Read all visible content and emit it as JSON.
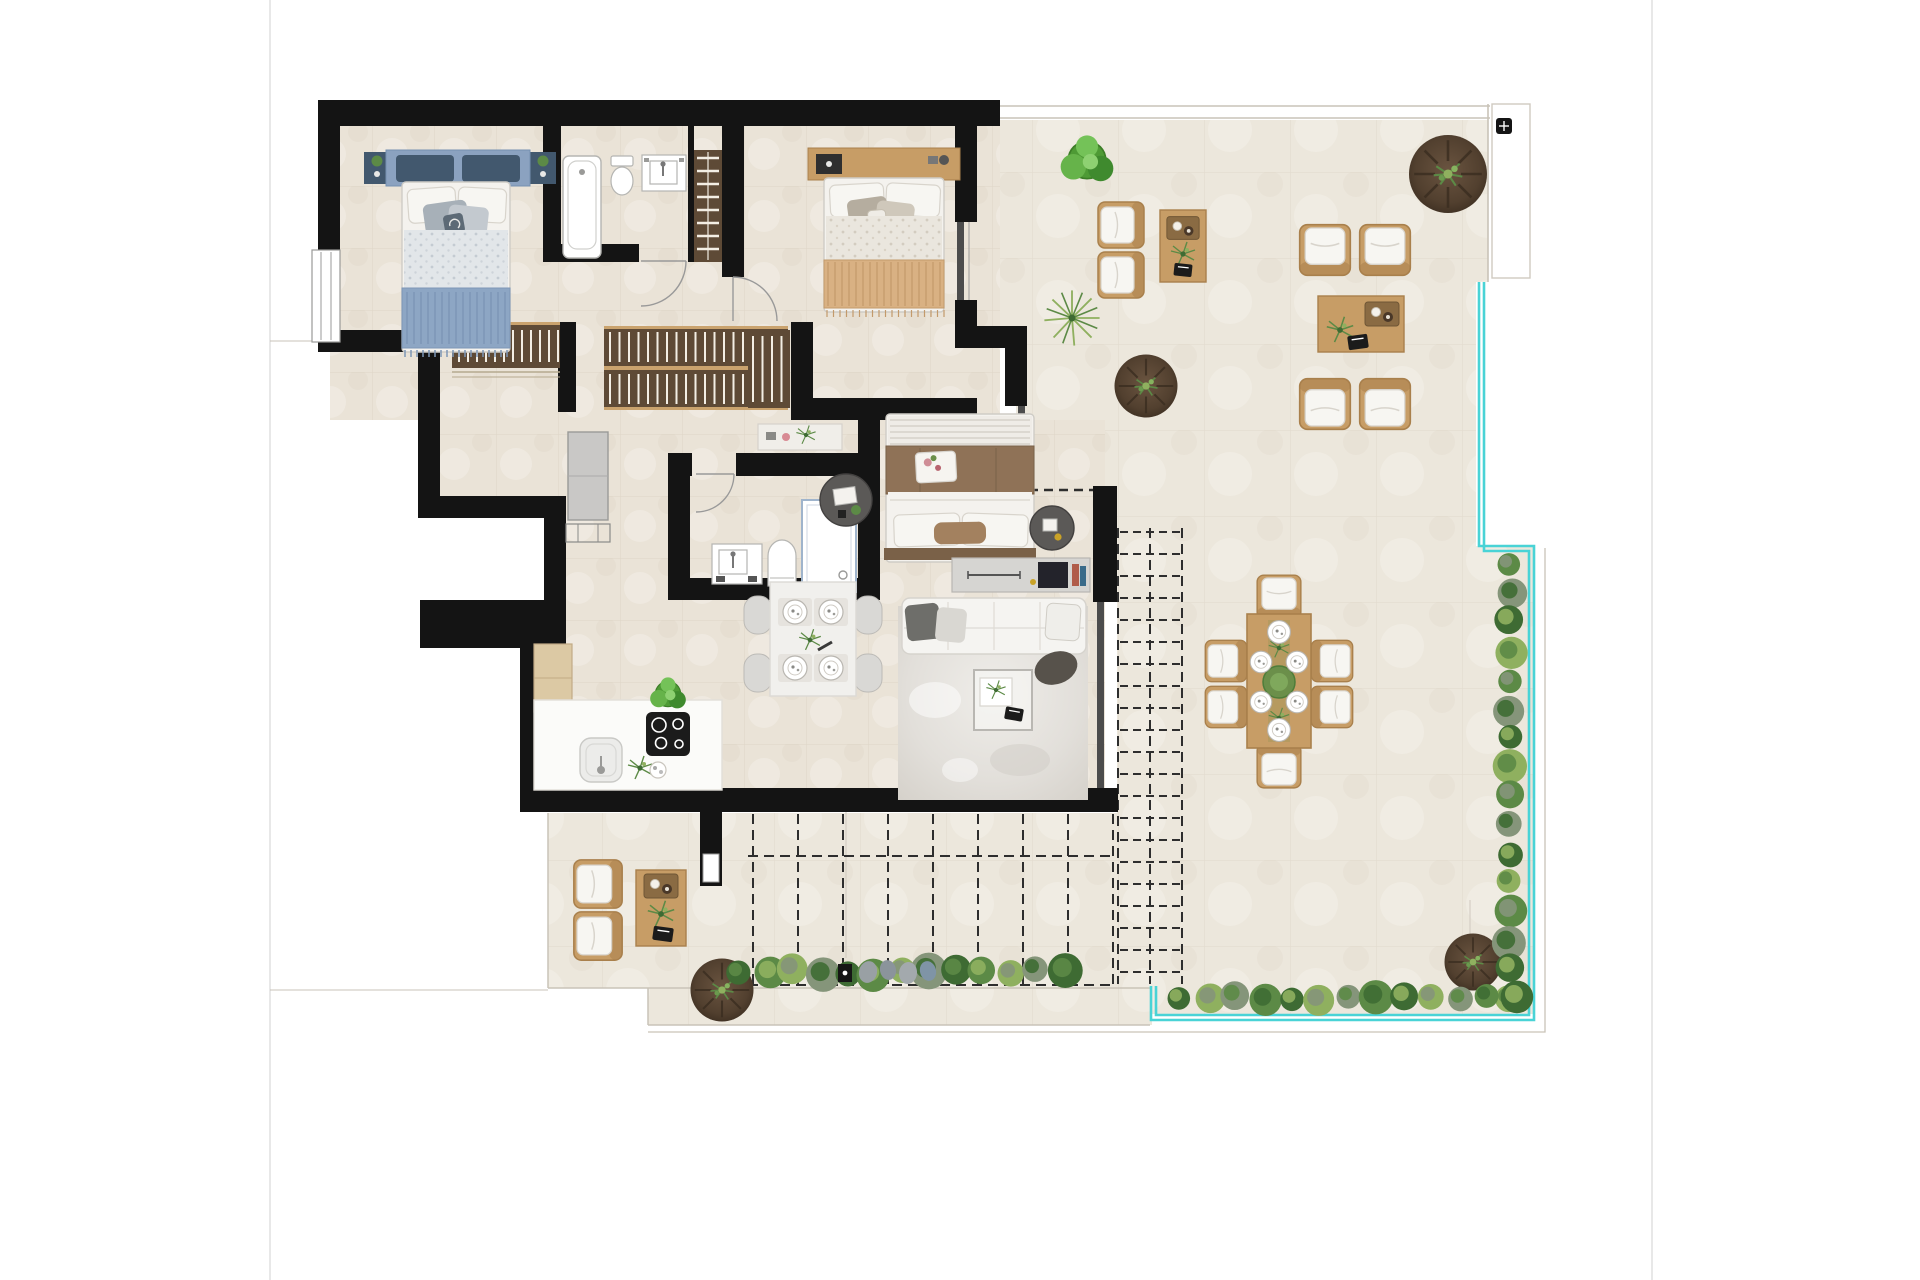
{
  "canvas": {
    "width": 1920,
    "height": 1280
  },
  "palette": {
    "wall": "#141414",
    "floorI": "#eae3d7",
    "floorT": "#ece7dc",
    "tileLine": "#d6cdbd",
    "wood": "#c79d66",
    "woodDark": "#a9804c",
    "closet": "#5e4a36",
    "closetSlat": "#f3eee4",
    "closetTrim": "#caa36e",
    "cushion": "#f7f6f2",
    "cushionBorder": "#d8d4cc",
    "pool": "#49d3d6",
    "lineGray": "#c9c3b8",
    "pageLine": "#e0e0e0",
    "dash": "#2e2e2e",
    "glass": "#4c4c4c",
    "plantDark": "#3e6b33",
    "plantMid": "#5c8a46",
    "plantLight": "#8fb05f",
    "plantSage": "#85957a",
    "planter": "#5a4633",
    "planterDark": "#3a2d20",
    "bedBlue": "#8da6c4",
    "blueDark": "#42586e",
    "blueHead": "#8ba2c0",
    "blueLine": "#7d96b6",
    "duvetBlue": "#e2e6e9",
    "bedTan": "#d9b183",
    "tanLine": "#c39a6b",
    "duvetTan": "#eae6de",
    "bedBrown": "#8f7257",
    "brownDark": "#7a6148",
    "whiteSoft": "#f4f2ee",
    "softBorder": "#cfccc6",
    "rug": "#e4e1dc",
    "console": "#d6d5d2",
    "stripeLight": "#dcd8d1",
    "tableWhite": "#f1f0ed",
    "grayUnit": "#c9c8c6",
    "fixtureBorder": "#b5b5b2"
  },
  "rooms": [
    {
      "id": "bedroom-blue"
    },
    {
      "id": "bathroom-main"
    },
    {
      "id": "bedroom-tan"
    },
    {
      "id": "hallway-closets"
    },
    {
      "id": "bathroom-ensuite"
    },
    {
      "id": "master-bedroom"
    },
    {
      "id": "kitchen-dining"
    },
    {
      "id": "living-room"
    },
    {
      "id": "terrace"
    },
    {
      "id": "terrace-lounge-sw"
    }
  ],
  "generators": [
    {
      "t": "gBedA",
      "k": "plants",
      "x": 740,
      "y": 972,
      "dx": 27,
      "dy": 0,
      "n": 13,
      "r": 15,
      "jit": 7,
      "colors": [
        "plantDark",
        "plantMid",
        "plantLight",
        "plantSage"
      ]
    },
    {
      "t": "gBedB",
      "k": "plants",
      "x": 1510,
      "y": 564,
      "dx": 0,
      "dy": 29,
      "n": 16,
      "r": 14,
      "jit": 5,
      "colors": [
        "plantMid",
        "plantSage",
        "plantDark",
        "plantLight"
      ]
    },
    {
      "t": "gBedC",
      "k": "plants",
      "x": 1180,
      "y": 998,
      "dx": 28,
      "dy": 0,
      "n": 13,
      "r": 14,
      "jit": 5,
      "colors": [
        "plantDark",
        "plantLight",
        "plantSage",
        "plantMid"
      ]
    },
    {
      "t": "gPergER",
      "k": "lines",
      "x1": 1120,
      "y1": 532,
      "x2": 1180,
      "y2": 532,
      "dx": 0,
      "dy": 22,
      "n": 21,
      "stroke": "dash",
      "w": 2,
      "dash": "8 5"
    },
    {
      "t": "gPergEV",
      "k": "lines",
      "x1": 1118,
      "y1": 528,
      "x2": 1118,
      "y2": 984,
      "dx": 32,
      "dy": 0,
      "n": 3,
      "stroke": "dash",
      "w": 2,
      "dash": "10 6"
    },
    {
      "t": "gPergSV",
      "k": "lines",
      "x1": 753,
      "y1": 814,
      "x2": 753,
      "y2": 986,
      "dx": 45,
      "dy": 0,
      "n": 9,
      "stroke": "dash",
      "w": 2,
      "dash": "10 6"
    },
    {
      "t": "gPergSH",
      "k": "lines",
      "x1": 748,
      "y1": 856,
      "x2": 1116,
      "y2": 856,
      "dx": 0,
      "dy": 129,
      "n": 2,
      "stroke": "dash",
      "w": 2,
      "dash": "10 6"
    },
    {
      "t": "gC1",
      "k": "lines",
      "x1": 697,
      "y1": 158,
      "x2": 719,
      "y2": 158,
      "dx": 0,
      "dy": 13,
      "n": 8,
      "stroke": "closetSlat",
      "w": 2.5
    },
    {
      "t": "gC2",
      "k": "lines",
      "x1": 459,
      "y1": 330,
      "x2": 459,
      "y2": 362,
      "dx": 9,
      "dy": 0,
      "n": 12,
      "stroke": "closetSlat",
      "w": 2
    },
    {
      "t": "gC3a",
      "k": "lines",
      "x1": 610,
      "y1": 332,
      "x2": 610,
      "y2": 362,
      "dx": 9.5,
      "dy": 0,
      "n": 18,
      "stroke": "closetSlat",
      "w": 2
    },
    {
      "t": "gC3b",
      "k": "lines",
      "x1": 610,
      "y1": 374,
      "x2": 610,
      "y2": 404,
      "dx": 9.5,
      "dy": 0,
      "n": 18,
      "stroke": "closetSlat",
      "w": 2
    },
    {
      "t": "gC4",
      "k": "lines",
      "x1": 753,
      "y1": 336,
      "x2": 753,
      "y2": 402,
      "dx": 9.5,
      "dy": 0,
      "n": 4,
      "stroke": "closetSlat",
      "w": 2
    },
    {
      "t": "gBlueStripe",
      "k": "lines",
      "x1": 407,
      "y1": 292,
      "x2": 407,
      "y2": 344,
      "dx": 7,
      "dy": 0,
      "n": 15,
      "stroke": "blueLine",
      "w": 1.5
    },
    {
      "t": "gBlueFringe",
      "k": "lines",
      "x1": 405,
      "y1": 350,
      "x2": 405,
      "y2": 357,
      "dx": 6,
      "dy": 0,
      "n": 18,
      "stroke": "blueLine",
      "w": 1.5
    },
    {
      "t": "gTanHatch",
      "k": "lines",
      "x1": 828,
      "y1": 262,
      "x2": 828,
      "y2": 306,
      "dx": 7,
      "dy": 0,
      "n": 17,
      "stroke": "tanLine",
      "w": 1.2
    },
    {
      "t": "gTanFringe",
      "k": "lines",
      "x1": 827,
      "y1": 310,
      "x2": 827,
      "y2": 317,
      "dx": 6.5,
      "dy": 0,
      "n": 19,
      "stroke": "tanLine",
      "w": 1.2
    },
    {
      "t": "gMasterStripe",
      "k": "lines",
      "x1": 890,
      "y1": 420,
      "x2": 1030,
      "y2": 420,
      "dx": 0,
      "dy": 6,
      "n": 6,
      "stroke": "stripeLight",
      "w": 2
    }
  ]
}
